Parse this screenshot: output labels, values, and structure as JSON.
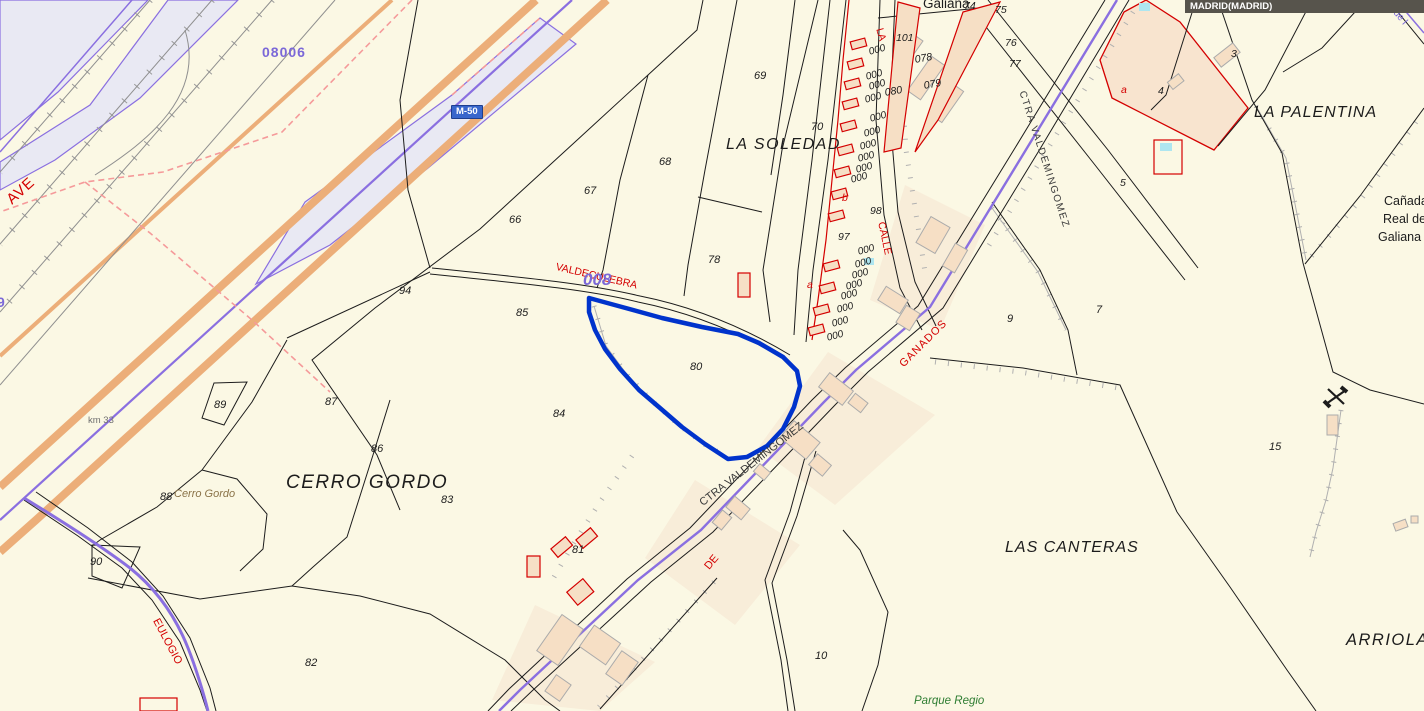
{
  "map": {
    "municipality_bar": "MADRID(MADRID)",
    "road_badge": "M-50",
    "colors": {
      "bg": "#FBF8E4",
      "line": "#1c1c1c",
      "purple": "#8a6fe0",
      "orange": "#ECAE79",
      "red": "#D40000",
      "selection_blue": "#0033CC",
      "lavender": "#E9E9F3",
      "beige_building": "#F6DFC5",
      "peach_parcel": "#F8E4CF",
      "pool_cyan": "#AEE6F0",
      "badge_blue": "#3866CC",
      "bar_gray": "#57544C"
    },
    "labels": [
      {
        "id": "label-galiana-top",
        "text": "Galiana",
        "x": 923,
        "y": -3,
        "size": 13.5,
        "color": "#1c1c1c"
      },
      {
        "id": "label-la-soledad",
        "text": "LA SOLEDAD",
        "x": 726,
        "y": 137,
        "size": 16,
        "color": "#1c1c1c",
        "italic": true,
        "spacing": 1.5
      },
      {
        "id": "label-la-palentina",
        "text": "LA PALENTINA",
        "x": 1254,
        "y": 105,
        "size": 16,
        "color": "#1c1c1c",
        "italic": true,
        "spacing": 1
      },
      {
        "id": "label-cerro-gordo",
        "text": "CERRO GORDO",
        "x": 286,
        "y": 473,
        "size": 19,
        "color": "#1c1c1c",
        "italic": true,
        "spacing": 1.5
      },
      {
        "id": "label-las-canteras",
        "text": "LAS CANTERAS",
        "x": 1005,
        "y": 540,
        "size": 16,
        "color": "#1c1c1c",
        "italic": true,
        "spacing": 1
      },
      {
        "id": "label-arriola",
        "text": "ARRIOLA",
        "x": 1346,
        "y": 632,
        "size": 16.5,
        "color": "#1c1c1c",
        "italic": true,
        "spacing": 1.5
      },
      {
        "id": "label-canada-line1",
        "text": "Cañada",
        "x": 1384,
        "y": 195,
        "size": 12.5,
        "color": "#1c1c1c"
      },
      {
        "id": "label-canada-line2",
        "text": "Real de",
        "x": 1383,
        "y": 213,
        "size": 12.5,
        "color": "#1c1c1c"
      },
      {
        "id": "label-canada-line3",
        "text": "Galiana",
        "x": 1378,
        "y": 231,
        "size": 12.5,
        "color": "#1c1c1c"
      },
      {
        "id": "label-cerro-gordo-small",
        "text": "Cerro Gordo",
        "x": 174,
        "y": 489,
        "size": 11,
        "color": "#8a7348",
        "italic": true
      },
      {
        "id": "label-parque-regio",
        "text": "Parque Regio",
        "x": 914,
        "y": 696,
        "size": 11.5,
        "color": "#2e7d32",
        "italic": true
      },
      {
        "id": "label-ave",
        "text": "AVE",
        "x": 4,
        "y": 196,
        "size": 15,
        "color": "#D40000",
        "rot": -42,
        "spacing": 1
      },
      {
        "id": "label-eulogio",
        "text": "EULOGIO",
        "x": 160,
        "y": 617,
        "size": 11,
        "color": "#D40000",
        "rot": 62
      },
      {
        "id": "label-ctra-valdemingomez-lower",
        "text": "CTRA VALDEMINGOMEZ",
        "x": 698,
        "y": 500,
        "size": 11,
        "color": "#3a3a3a",
        "rot": -38
      },
      {
        "id": "label-ctra-valdemingomez-upper",
        "text": "CTRA VALDEMINGOMEZ",
        "x": 1026,
        "y": 90,
        "size": 10,
        "color": "#3a3a3a",
        "rot": 72,
        "spacing": 1.5
      },
      {
        "id": "label-ganados",
        "text": "GANADOS",
        "x": 898,
        "y": 362,
        "size": 11,
        "color": "#D40000",
        "rot": -45,
        "spacing": 1
      },
      {
        "id": "label-de",
        "text": "DE",
        "x": 703,
        "y": 565,
        "size": 11,
        "color": "#D40000",
        "rot": -50
      },
      {
        "id": "label-valdeculebra",
        "text": "VALDECULEBRA",
        "x": 557,
        "y": 262,
        "size": 10.5,
        "color": "#D40000",
        "rot": 13
      },
      {
        "id": "label-calle",
        "text": "CALLE",
        "x": 886,
        "y": 221,
        "size": 10.5,
        "color": "#D40000",
        "rot": 78
      },
      {
        "id": "label-la-street",
        "text": "LA",
        "x": 884,
        "y": 27,
        "size": 10.5,
        "color": "#D40000",
        "rot": 75
      },
      {
        "id": "label-polygon-008",
        "text": "008",
        "x": 583,
        "y": 271,
        "size": 17,
        "color": "#7B68D8",
        "italic": true,
        "bold": true
      },
      {
        "id": "label-polygon-08006",
        "text": "08006",
        "x": 262,
        "y": 45,
        "size": 14,
        "color": "#7B68D8",
        "bold": true,
        "spacing": 1
      },
      {
        "id": "label-km33",
        "text": "km 33",
        "x": 88,
        "y": 416,
        "size": 9.5,
        "color": "#707070"
      },
      {
        "id": "label-o-de-l",
        "text": "o de l",
        "x": 1393,
        "y": 2,
        "size": 10,
        "color": "#7B68D8",
        "rot": 50
      },
      {
        "id": "label-purple-9",
        "text": "9",
        "x": -3,
        "y": 295,
        "size": 14,
        "color": "#7B68D8",
        "bold": true
      },
      {
        "id": "parcel-66",
        "text": "66",
        "x": 509,
        "y": 215,
        "size": 11,
        "color": "#1c1c1c",
        "italic": true
      },
      {
        "id": "parcel-67",
        "text": "67",
        "x": 584,
        "y": 186,
        "size": 11,
        "color": "#1c1c1c",
        "italic": true
      },
      {
        "id": "parcel-68",
        "text": "68",
        "x": 659,
        "y": 157,
        "size": 11,
        "color": "#1c1c1c",
        "italic": true
      },
      {
        "id": "parcel-69",
        "text": "69",
        "x": 754,
        "y": 71,
        "size": 11,
        "color": "#1c1c1c",
        "italic": true
      },
      {
        "id": "parcel-70",
        "text": "70",
        "x": 811,
        "y": 122,
        "size": 11,
        "color": "#1c1c1c",
        "italic": true
      },
      {
        "id": "parcel-78",
        "text": "78",
        "x": 708,
        "y": 255,
        "size": 11,
        "color": "#1c1c1c",
        "italic": true
      },
      {
        "id": "parcel-94",
        "text": "94",
        "x": 399,
        "y": 286,
        "size": 11,
        "color": "#1c1c1c",
        "italic": true
      },
      {
        "id": "parcel-85",
        "text": "85",
        "x": 516,
        "y": 308,
        "size": 11,
        "color": "#1c1c1c",
        "italic": true
      },
      {
        "id": "parcel-80",
        "text": "80",
        "x": 690,
        "y": 362,
        "size": 11,
        "color": "#1c1c1c",
        "italic": true
      },
      {
        "id": "parcel-87",
        "text": "87",
        "x": 325,
        "y": 397,
        "size": 11,
        "color": "#1c1c1c",
        "italic": true
      },
      {
        "id": "parcel-84",
        "text": "84",
        "x": 553,
        "y": 409,
        "size": 11,
        "color": "#1c1c1c",
        "italic": true
      },
      {
        "id": "parcel-86",
        "text": "86",
        "x": 371,
        "y": 444,
        "size": 11,
        "color": "#1c1c1c",
        "italic": true
      },
      {
        "id": "parcel-83",
        "text": "83",
        "x": 441,
        "y": 495,
        "size": 11,
        "color": "#1c1c1c",
        "italic": true
      },
      {
        "id": "parcel-89",
        "text": "89",
        "x": 214,
        "y": 400,
        "size": 11,
        "color": "#1c1c1c",
        "italic": true
      },
      {
        "id": "parcel-88",
        "text": "88",
        "x": 160,
        "y": 492,
        "size": 11,
        "color": "#1c1c1c",
        "italic": true
      },
      {
        "id": "parcel-90",
        "text": "90",
        "x": 90,
        "y": 557,
        "size": 11,
        "color": "#1c1c1c",
        "italic": true
      },
      {
        "id": "parcel-82",
        "text": "82",
        "x": 305,
        "y": 658,
        "size": 11,
        "color": "#1c1c1c",
        "italic": true
      },
      {
        "id": "parcel-81",
        "text": "81",
        "x": 572,
        "y": 545,
        "size": 11,
        "color": "#1c1c1c",
        "italic": true
      },
      {
        "id": "parcel-9",
        "text": "9",
        "x": 1007,
        "y": 314,
        "size": 11,
        "color": "#1c1c1c",
        "italic": true
      },
      {
        "id": "parcel-7",
        "text": "7",
        "x": 1096,
        "y": 305,
        "size": 11,
        "color": "#1c1c1c",
        "italic": true
      },
      {
        "id": "parcel-15",
        "text": "15",
        "x": 1269,
        "y": 442,
        "size": 11,
        "color": "#1c1c1c",
        "italic": true
      },
      {
        "id": "parcel-10",
        "text": "10",
        "x": 815,
        "y": 651,
        "size": 11,
        "color": "#1c1c1c",
        "italic": true
      },
      {
        "id": "parcel-74",
        "text": "74",
        "x": 964,
        "y": 1,
        "size": 10.5,
        "color": "#1c1c1c",
        "italic": true
      },
      {
        "id": "parcel-75",
        "text": "75",
        "x": 995,
        "y": 5,
        "size": 10.5,
        "color": "#1c1c1c",
        "italic": true
      },
      {
        "id": "parcel-76",
        "text": "76",
        "x": 1005,
        "y": 38,
        "size": 10.5,
        "color": "#1c1c1c",
        "italic": true
      },
      {
        "id": "parcel-77",
        "text": "77",
        "x": 1009,
        "y": 59,
        "size": 10.5,
        "color": "#1c1c1c",
        "italic": true
      },
      {
        "id": "parcel-101",
        "text": "101",
        "x": 896,
        "y": 33,
        "size": 10.5,
        "color": "#1c1c1c",
        "italic": true
      },
      {
        "id": "parcel-078",
        "text": "078",
        "x": 914,
        "y": 55,
        "size": 10.5,
        "color": "#1c1c1c",
        "italic": true,
        "rot": -10
      },
      {
        "id": "parcel-079",
        "text": "079",
        "x": 923,
        "y": 81,
        "size": 10.5,
        "color": "#1c1c1c",
        "italic": true,
        "rot": -10
      },
      {
        "id": "parcel-080",
        "text": "080",
        "x": 884,
        "y": 88,
        "size": 10.5,
        "color": "#1c1c1c",
        "italic": true,
        "rot": -10
      },
      {
        "id": "parcel-98",
        "text": "98",
        "x": 870,
        "y": 206,
        "size": 10.5,
        "color": "#1c1c1c",
        "italic": true
      },
      {
        "id": "parcel-97",
        "text": "97",
        "x": 838,
        "y": 232,
        "size": 10.5,
        "color": "#1c1c1c",
        "italic": true
      },
      {
        "id": "parcel-3",
        "text": "3",
        "x": 1231,
        "y": 49,
        "size": 10.5,
        "color": "#1c1c1c",
        "italic": true
      },
      {
        "id": "parcel-4",
        "text": "4",
        "x": 1158,
        "y": 86,
        "size": 10.5,
        "color": "#1c1c1c",
        "italic": true
      },
      {
        "id": "parcel-5",
        "text": "5",
        "x": 1120,
        "y": 178,
        "size": 10.5,
        "color": "#1c1c1c",
        "italic": true
      },
      {
        "id": "subparcel-a1",
        "text": "a",
        "x": 1121,
        "y": 85,
        "size": 10.5,
        "color": "#D40000",
        "italic": true
      },
      {
        "id": "subparcel-a2",
        "text": "a",
        "x": 807,
        "y": 280,
        "size": 10.5,
        "color": "#D40000",
        "italic": true
      },
      {
        "id": "subparcel-b",
        "text": "b",
        "x": 842,
        "y": 193,
        "size": 10.5,
        "color": "#D40000",
        "italic": true
      }
    ],
    "house_numbers_text": "000",
    "house_numbers": [
      [
        868,
        48
      ],
      [
        865,
        73
      ],
      [
        868,
        83
      ],
      [
        864,
        96
      ],
      [
        869,
        115
      ],
      [
        863,
        130
      ],
      [
        859,
        143
      ],
      [
        857,
        155
      ],
      [
        855,
        166
      ],
      [
        850,
        176
      ],
      [
        857,
        248
      ],
      [
        854,
        261
      ],
      [
        851,
        272
      ],
      [
        845,
        283
      ],
      [
        840,
        293
      ],
      [
        836,
        306
      ],
      [
        831,
        320
      ],
      [
        826,
        334
      ]
    ],
    "red_strip_buildings": [
      [
        851,
        40
      ],
      [
        848,
        60
      ],
      [
        845,
        80
      ],
      [
        843,
        100
      ],
      [
        841,
        122
      ],
      [
        838,
        146
      ],
      [
        835,
        168
      ],
      [
        832,
        190
      ],
      [
        829,
        212
      ],
      [
        824,
        262
      ],
      [
        820,
        284
      ],
      [
        814,
        306
      ],
      [
        809,
        326
      ]
    ]
  }
}
